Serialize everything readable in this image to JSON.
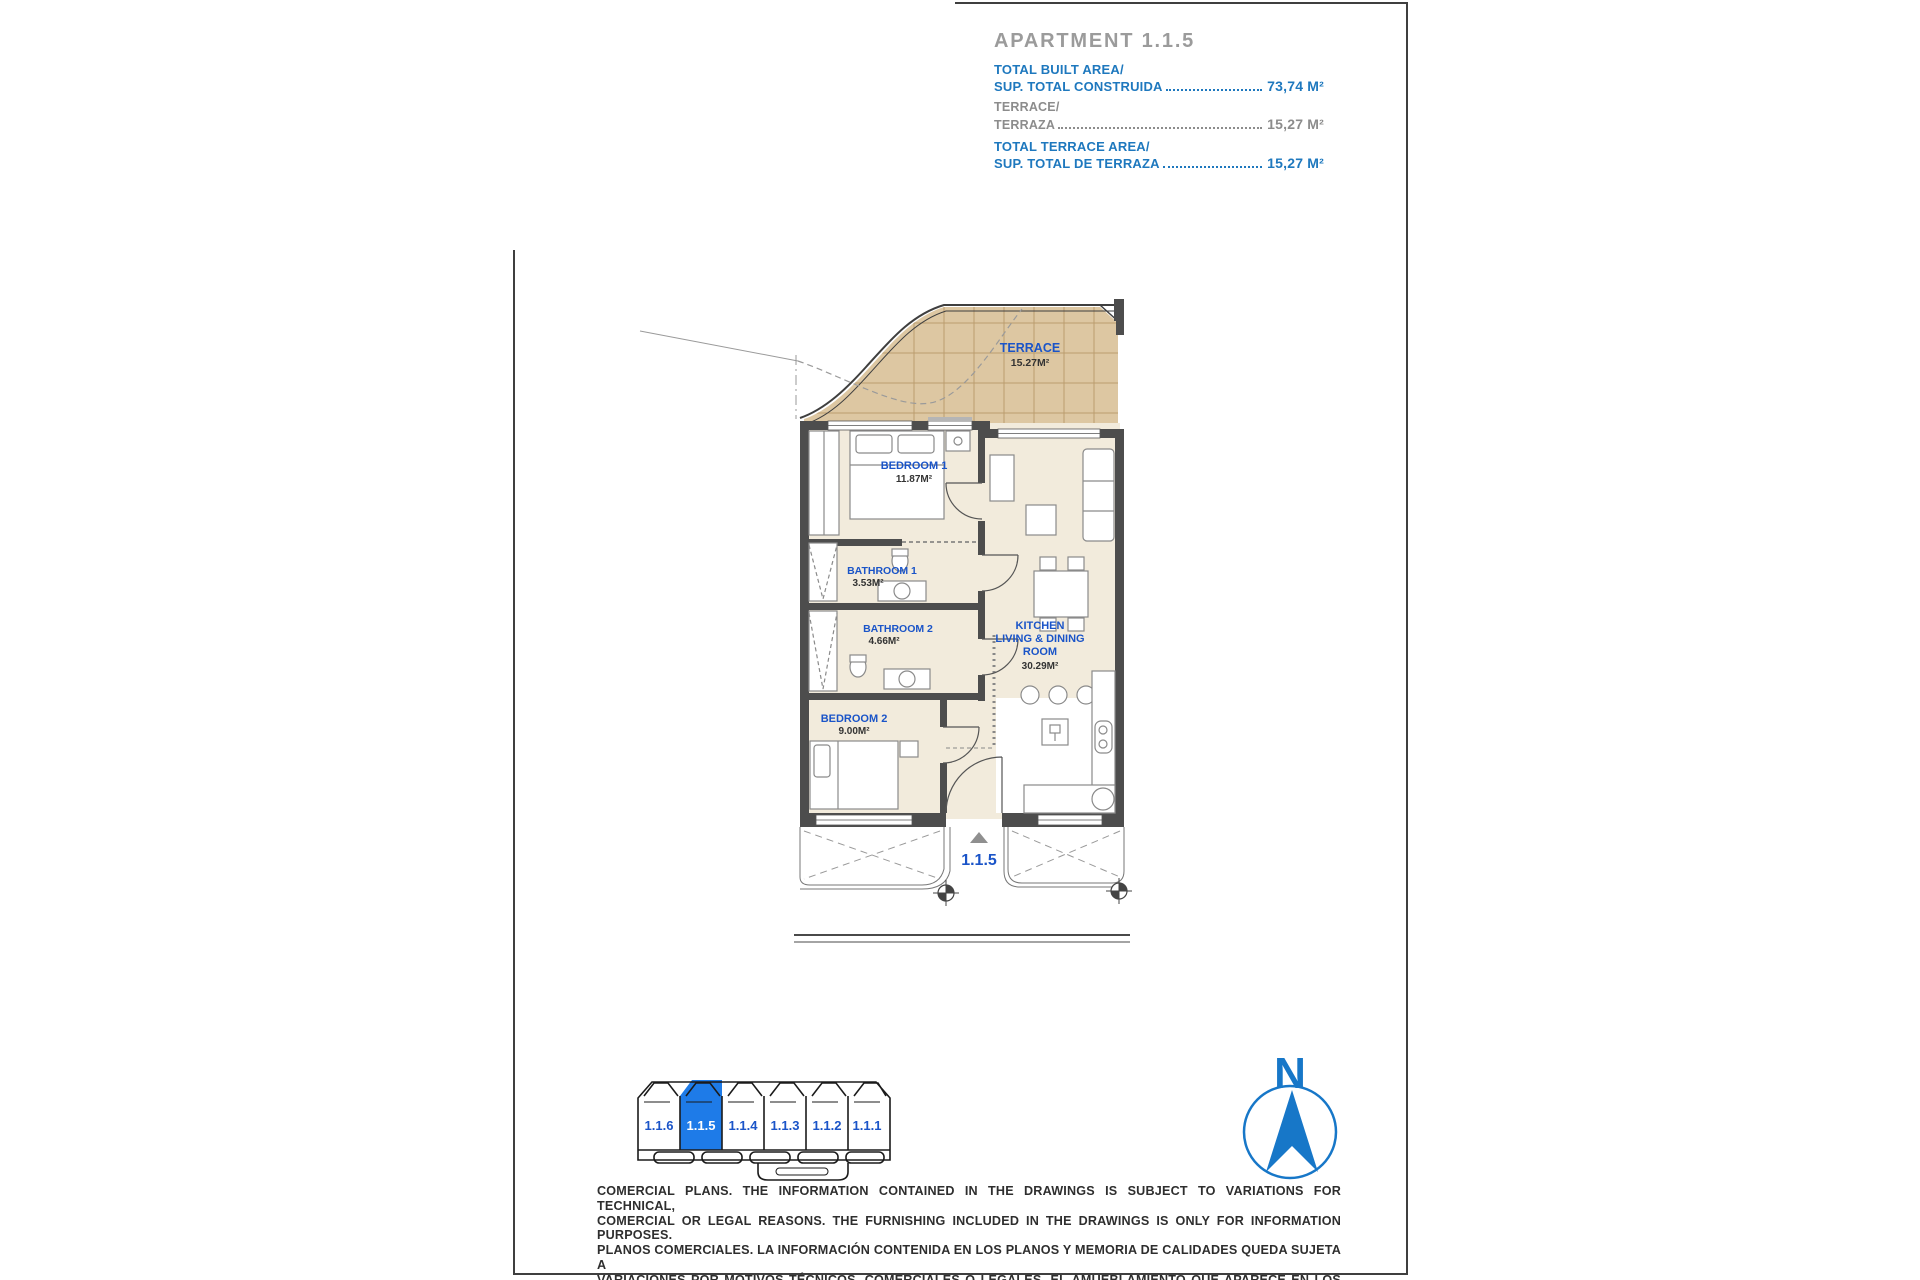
{
  "header": {
    "title": "APARTMENT 1.1.5",
    "rows": [
      {
        "label_en": "TOTAL BUILT AREA/",
        "label_es": "SUP. TOTAL CONSTRUIDA",
        "value": "73,74 M²",
        "emphasis": "primary"
      },
      {
        "label_en": "TERRACE/",
        "label_es": "TERRAZA",
        "value": "15,27 M²",
        "emphasis": "secondary"
      },
      {
        "label_en": "TOTAL TERRACE AREA/",
        "label_es": "SUP. TOTAL DE TERRAZA",
        "value": "15,27 M²",
        "emphasis": "primary"
      }
    ]
  },
  "plan": {
    "rooms": {
      "terrace": {
        "name": "TERRACE",
        "area": "15.27M²"
      },
      "bedroom1": {
        "name": "BEDROOM 1",
        "area": "11.87M²"
      },
      "bathroom1": {
        "name": "BATHROOM 1",
        "area": "3.53M²"
      },
      "bathroom2": {
        "name": "BATHROOM 2",
        "area": "4.66M²"
      },
      "kitchen": {
        "line1": "KITCHEN",
        "line2": "LIVING & DINING",
        "line3": "ROOM",
        "area": "30.29M²"
      },
      "bedroom2": {
        "name": "BEDROOM 2",
        "area": "9.00M²"
      }
    },
    "entrance_unit_label": "1.1.5"
  },
  "keyplan": {
    "units": [
      {
        "label": "1.1.6",
        "highlighted": false
      },
      {
        "label": "1.1.5",
        "highlighted": true
      },
      {
        "label": "1.1.4",
        "highlighted": false
      },
      {
        "label": "1.1.3",
        "highlighted": false
      },
      {
        "label": "1.1.2",
        "highlighted": false
      },
      {
        "label": "1.1.1",
        "highlighted": false
      }
    ]
  },
  "compass": {
    "north_label": "N"
  },
  "disclaimer": {
    "lines": [
      "COMERCIAL PLANS. THE INFORMATION CONTAINED IN THE DRAWINGS IS SUBJECT TO VARIATIONS FOR TECHNICAL,",
      "COMERCIAL OR LEGAL REASONS. THE FURNISHING INCLUDED IN THE DRAWINGS IS ONLY FOR INFORMATION PURPOSES.",
      "PLANOS COMERCIALES. LA INFORMACIÓN CONTENIDA EN LOS PLANOS Y MEMORIA DE CALIDADES QUEDA SUJETA A",
      "VARIACIONES POR MOTIVOS TÉCNICOS, COMERCIALES O LEGALES. EL AMUEBLAMIENTO QUE APARECE EN LOS PLANOS",
      "ES MERAMENTE INFORMATIVO."
    ]
  },
  "colors": {
    "header_blue": "#1E78BE",
    "header_gray": "#8C8C8C",
    "title_gray": "#9B9B9B",
    "room_label_blue": "#1A54C8",
    "keyplan_highlight": "#1E7BE8",
    "compass_blue": "#1777C8",
    "terrace_fill": "#DDC7A2",
    "terrace_grid": "#BA9C6E",
    "room_fill": "#F2EBDC",
    "wall_dark": "#4D4D4D"
  }
}
